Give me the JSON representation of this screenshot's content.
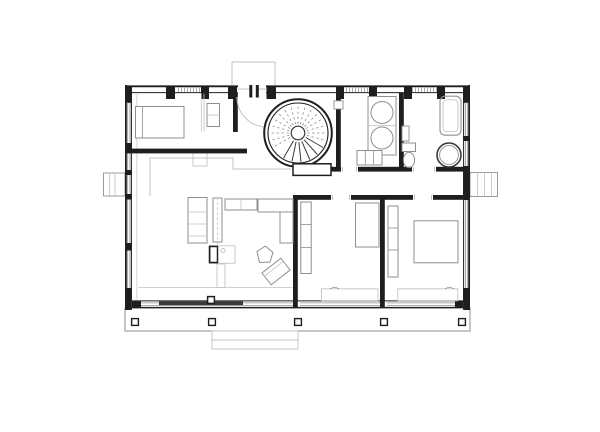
{
  "page": {
    "description": "Architectural ground-floor plan drawing of a house, black and grey line work on white paper, no text labels"
  },
  "palette": {
    "wall": "#1e1e1e",
    "ink": "#3a3a3a",
    "mid": "#8f8f8f",
    "lt": "#c2c2c2",
    "paper": "#ffffff"
  },
  "plan": {
    "drawing_type": "floor-plan",
    "rooms": [
      {
        "id": "bedroom-top-left",
        "fixtures": [
          "double-bed",
          "pillow-line",
          "wall-shelf",
          "closet-partition"
        ]
      },
      {
        "id": "entry-hall",
        "fixtures": [
          "entrance-door",
          "door-swing-arc",
          "step-outline"
        ]
      },
      {
        "id": "stair-hall",
        "fixtures": [
          "spiral-staircase",
          "stair-landing",
          "stair-treads"
        ]
      },
      {
        "id": "laundry-room",
        "fixtures": [
          "appliance-counter",
          "round-basin",
          "round-basin",
          "base-cabinet",
          "small-box"
        ]
      },
      {
        "id": "bathroom",
        "fixtures": [
          "bathtub",
          "toilet",
          "round-shower-basin",
          "wall-shelf"
        ]
      },
      {
        "id": "living-kitchen",
        "fixtures": [
          "kitchen-counter",
          "kitchen-island",
          "section-dashline",
          "sideboard",
          "corner-sofa",
          "wood-stove",
          "side-table",
          "lounge-chair-pentagon",
          "lounge-chair-rotated",
          "sliding-glass-door",
          "door-post"
        ]
      },
      {
        "id": "bedroom-1",
        "fixtures": [
          "wardrobe",
          "dresser",
          "low-bench",
          "curtain-arc"
        ]
      },
      {
        "id": "bedroom-2",
        "fixtures": [
          "wardrobe",
          "double-bed",
          "low-bench",
          "curtain-arc"
        ]
      }
    ],
    "exterior_elements": [
      {
        "id": "entrance-canopy"
      },
      {
        "id": "bay-box-left"
      },
      {
        "id": "bay-box-right"
      },
      {
        "id": "rear-deck",
        "post_count": 5
      },
      {
        "id": "garden-steps",
        "step_count": 2
      }
    ],
    "window_count_top_wall": 3
  }
}
